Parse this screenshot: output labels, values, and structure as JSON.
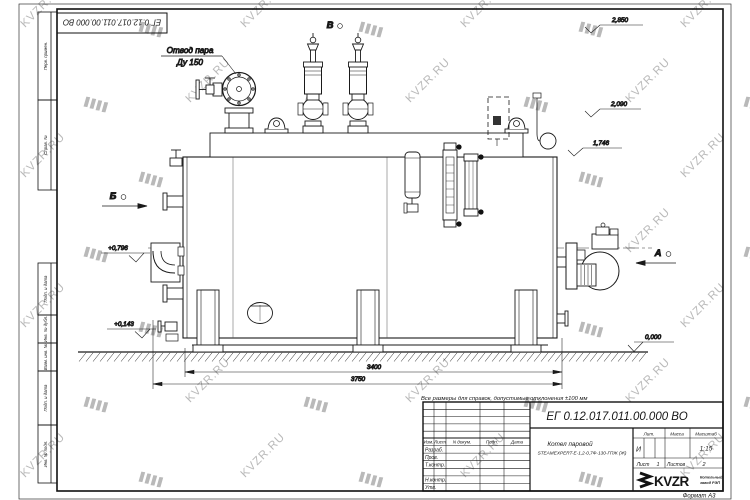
{
  "watermark": {
    "text": "KVZR.RU"
  },
  "margin_labels": {
    "perv": "Перв. примен.",
    "sprav": "Справ. №",
    "podp_data_1": "Подп. и дата",
    "inv_dubl": "Инв. № дубл.",
    "vzam_inv": "Взам. инв. №",
    "podp_data_2": "Подп. и дата",
    "inv_podl": "Инв. № подл."
  },
  "annotations": {
    "note": "Все размеры для справок, допустимые отклонения ±100 мм",
    "steam_outlet": {
      "line1": "Отвод пара",
      "line2": "Ду 150"
    },
    "view_markers": {
      "a": "А",
      "b": "Б",
      "v": "В"
    },
    "elevations": {
      "valves_top": "2,850",
      "platform_top": "2,090",
      "shell_top": "1,746",
      "elbow_axis": "+0,796",
      "shell_bottom": "+0,143",
      "ground": "0,000"
    },
    "dimensions": {
      "support_span": "3400",
      "overall_length": "3750"
    }
  },
  "title_block": {
    "doc_number": "ЕГ 0.12.017.011.00.000 ВО",
    "product_name_line1": "Котел паровой",
    "product_name_line2": "STEAMEXPERT-Е-1,2-0,7Ф-130-ГПЖ (Ж)",
    "header_izm": "Изм.",
    "header_list": "Лист",
    "header_ndoc": "N докум.",
    "header_podp": "Подп.",
    "header_data": "Дата",
    "row_razrab": "Разраб.",
    "row_prov": "Пров.",
    "row_tkontr": "Т.контр.",
    "row_nkontr": "Н.контр.",
    "row_utv": "Утв.",
    "lit_header": "Лит.",
    "mass_header": "Масса",
    "scale_header": "Масштаб",
    "lit_value": "И",
    "scale_value": "1:15",
    "sheet_label": "Лист",
    "sheet_value": "1",
    "sheets_label": "Листов",
    "sheets_value": "2",
    "company_logo": "KVZR",
    "company_line1": "Котельный",
    "company_line2": "завод РЭП",
    "format": "Формат А3"
  }
}
